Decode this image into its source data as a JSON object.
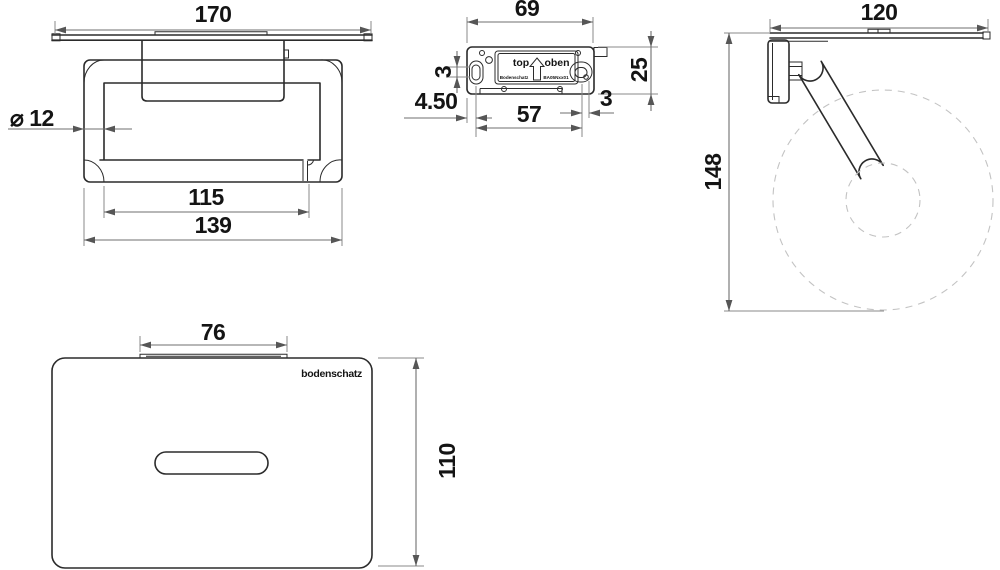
{
  "drawing": {
    "title": "toilet-roll-holder-technical-drawing",
    "colors": {
      "line": "#2b2b2b",
      "dimension": "#6f6f6f",
      "dashed_roll": "#c3c3c3",
      "background": "#ffffff"
    },
    "views": {
      "front": {
        "dims": {
          "width": "170",
          "diameter": "⌀ 12",
          "inner_width": "115",
          "outer_width": "139"
        }
      },
      "mounting_plate": {
        "dims": {
          "width": "69",
          "height": "25",
          "slot_play": "3",
          "edge_offset": "4.50",
          "hole_distance": "57",
          "hole_offset": "3"
        },
        "labels": {
          "top": "top",
          "oben": "oben",
          "small_left": "Bodenschatz",
          "small_right": "BA05Nxx01"
        }
      },
      "side": {
        "dims": {
          "depth": "120",
          "height": "148"
        }
      },
      "top": {
        "dims": {
          "bracket_width": "76",
          "depth": "110"
        },
        "brand": "bodenschatz"
      }
    }
  }
}
